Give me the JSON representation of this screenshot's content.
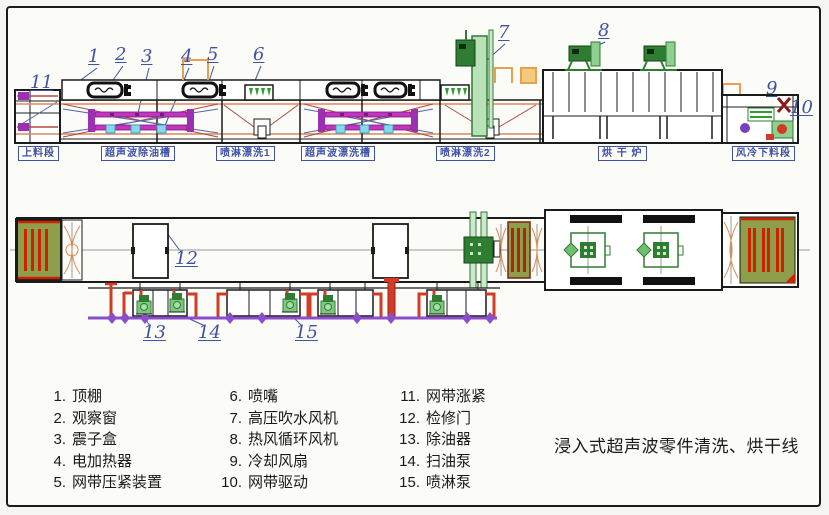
{
  "title": "浸入式超声波零件清洗、烘干线",
  "top_view": {
    "section_labels": [
      "上料段",
      "超声波除油槽",
      "喷淋漂洗1",
      "超声波漂洗槽",
      "喷淋漂洗2",
      "烘 干 炉",
      "风冷下料段"
    ],
    "callouts": [
      "1",
      "2",
      "3",
      "4",
      "5",
      "6",
      "7",
      "8",
      "9",
      "10",
      "11"
    ]
  },
  "bottom_view": {
    "callouts": [
      "12",
      "13",
      "14",
      "15"
    ]
  },
  "legend": {
    "items": [
      {
        "n": "1.",
        "label": "顶棚"
      },
      {
        "n": "2.",
        "label": "观察窗"
      },
      {
        "n": "3.",
        "label": "震子盒"
      },
      {
        "n": "4.",
        "label": "电加热器"
      },
      {
        "n": "5.",
        "label": "网带压紧装置"
      },
      {
        "n": "6.",
        "label": "喷嘴"
      },
      {
        "n": "7.",
        "label": "高压吹水风机"
      },
      {
        "n": "8.",
        "label": "热风循环风机"
      },
      {
        "n": "9.",
        "label": "冷却风扇"
      },
      {
        "n": "10.",
        "label": "网带驱动"
      },
      {
        "n": "11.",
        "label": "网带涨紧"
      },
      {
        "n": "12.",
        "label": "检修门"
      },
      {
        "n": "13.",
        "label": "除油器"
      },
      {
        "n": "14.",
        "label": "扫油泵"
      },
      {
        "n": "15.",
        "label": "喷淋泵"
      }
    ]
  },
  "colors": {
    "callout_blue": "#3f51a3",
    "line_black": "#1b1b1b",
    "belt_orange": "#d98a5f",
    "tank_red": "#b5493b",
    "tank_blue": "#5166ad",
    "transducer_magenta": "#c036c0",
    "pipe_red": "#d23b26",
    "pipe_purple": "#8a4fc8",
    "machine_green": "#2e7d32",
    "panel_olive": "#8f9e4a",
    "stand_orange": "#e8a050",
    "coolant_cyan": "#86d9ec"
  }
}
